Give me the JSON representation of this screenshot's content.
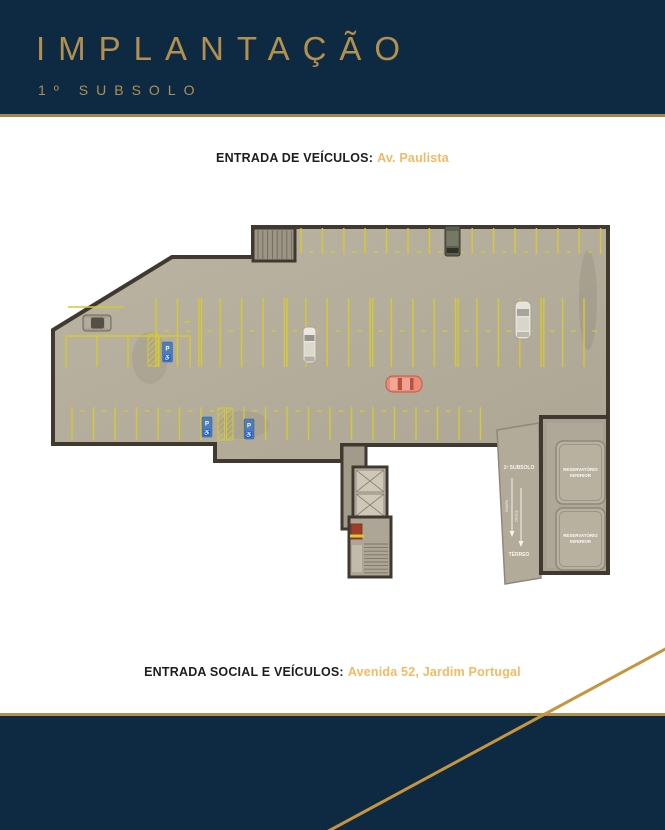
{
  "header": {
    "title": "IMPLANTAÇÃO",
    "subtitle": "1º SUBSOLO"
  },
  "entrances": {
    "top": {
      "label": "ENTRADA DE VEÍCULOS:",
      "value": "Av. Paulista"
    },
    "bottom": {
      "label": "ENTRADA SOCIAL E VEÍCULOS:",
      "value": "Avenida 52, Jardim Portugal"
    }
  },
  "plan": {
    "ramp": {
      "top_label": "1º SUBSOLO",
      "bottom_label": "TÉRREO",
      "arrow_label_1": "RAMPA",
      "arrow_label_2": "DESCE"
    },
    "tanks": [
      {
        "line1": "RESERVATÓRIO",
        "line2": "INFERIOR"
      },
      {
        "line1": "RESERVATÓRIO",
        "line2": "INFERIOR"
      }
    ],
    "accessibility": {
      "letter": "P",
      "symbol": "♿"
    }
  },
  "colors": {
    "navy": "#0e2a42",
    "gold": "#b2904e",
    "gold_line": "#c6953f",
    "amber_text": "#f3ba62",
    "floor": "#b6ae9c",
    "wall": "#3f3930",
    "parking_yellow": "#d4ca33",
    "sign_blue": "#4d7cb8",
    "car_salmon": "#ec8b77"
  }
}
